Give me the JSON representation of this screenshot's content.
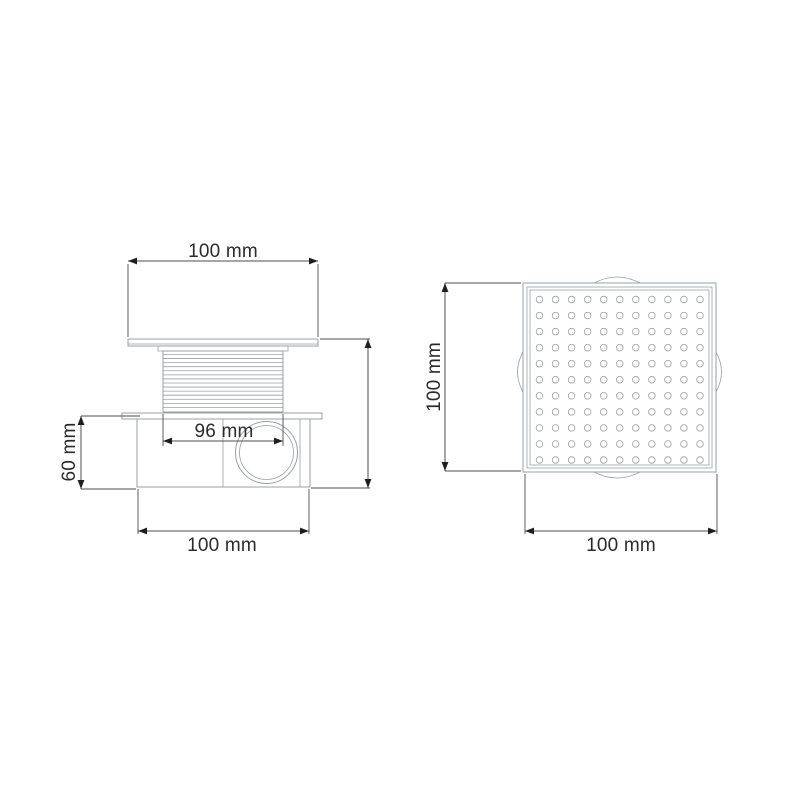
{
  "colors": {
    "background": "#ffffff",
    "part_outline": "#9aa0a4",
    "dimension_line": "#4d4d4d",
    "arrow": "#1f1f1f",
    "label_text": "#2b2b2b"
  },
  "side_view": {
    "dims": {
      "top_width": "100 mm",
      "thread_width": "96 mm",
      "height": "60 mm",
      "bottom_width": "100 mm"
    }
  },
  "top_view": {
    "dims": {
      "height": "100 mm",
      "width": "100 mm"
    },
    "grate": {
      "rows": 11,
      "cols": 11
    }
  }
}
